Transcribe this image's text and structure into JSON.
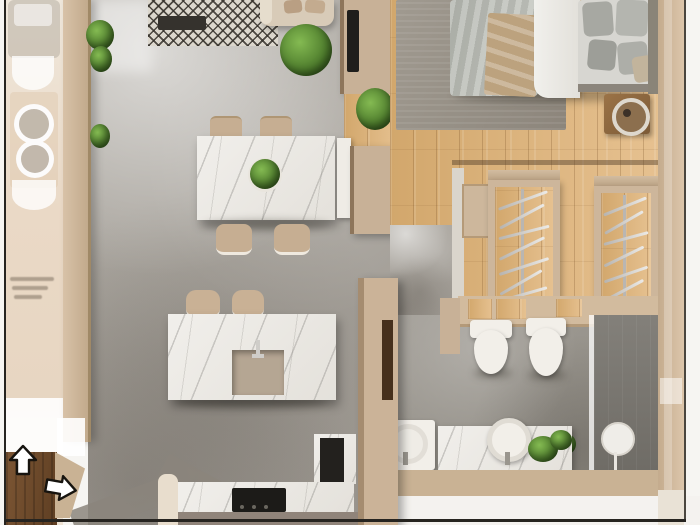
{
  "meta": {
    "title": "3D apartment floor plan, top-down render"
  },
  "palette": {
    "outside_white": "#f6f5f2",
    "frame_line": "#262420",
    "wall_beige": "#cdb69b",
    "wall_beige_dark": "#a08967",
    "concrete_gray": "#a8a49d",
    "wood_floor": "#dcb27d",
    "entry_door_brown": "#6b4a2d",
    "marble_white": "#edebe6",
    "rug_pattern_dark": "#34302a",
    "rug_pattern_light": "#dcd7cd",
    "bedroom_rug_gray": "#968e85",
    "bedding_gray": "#b7bab4",
    "bedding_white": "#eceae6",
    "throw_beige": "#bca27e",
    "plant_green": "#55832f",
    "appliance_black": "#23211e",
    "chrome_silver": "#cfcdc9",
    "shower_gray": "#7d7a74",
    "arrow_fill": "#ffffff",
    "arrow_outline": "#17140f"
  },
  "rooms": {
    "living_dining": "Living and dining area",
    "kitchen": "Kitchen",
    "bedroom": "Bedroom",
    "closet": "Walk-in closet",
    "bathroom": "Bathroom",
    "entry": "Entry"
  },
  "icons": {
    "up_arrow": "entry-direction-arrow-up",
    "right_arrow": "entry-direction-arrow-right"
  },
  "objects": {
    "sofa": "Sofa with cushions",
    "area_rug": "Patterned area rug",
    "coffee_table": "Dark coffee table tray",
    "dining_table": "Marble dining table",
    "dining_chair": "Dining chair",
    "centerpiece_plant": "Table centerpiece plant",
    "tv": "Wall-mounted TV",
    "bed": "Double bed with gray bedding",
    "bedroom_rug": "Gray bedroom rug",
    "nightstand": "Nightstand with round lamp",
    "wardrobe": "Open wardrobe with hangers",
    "toilet": "Wall-hung toilet",
    "bidet": "Wall-hung bidet",
    "vanity_sink": "Round vessel sink",
    "shower": "Walk-in shower",
    "kitchen_island": "Marble kitchen island with sink",
    "bar_stool": "Bar stool",
    "cooktop": "Black cooktop",
    "oven": "Built-in dark appliance",
    "entry_door": "Open entry door",
    "plant": "Potted green plant"
  }
}
